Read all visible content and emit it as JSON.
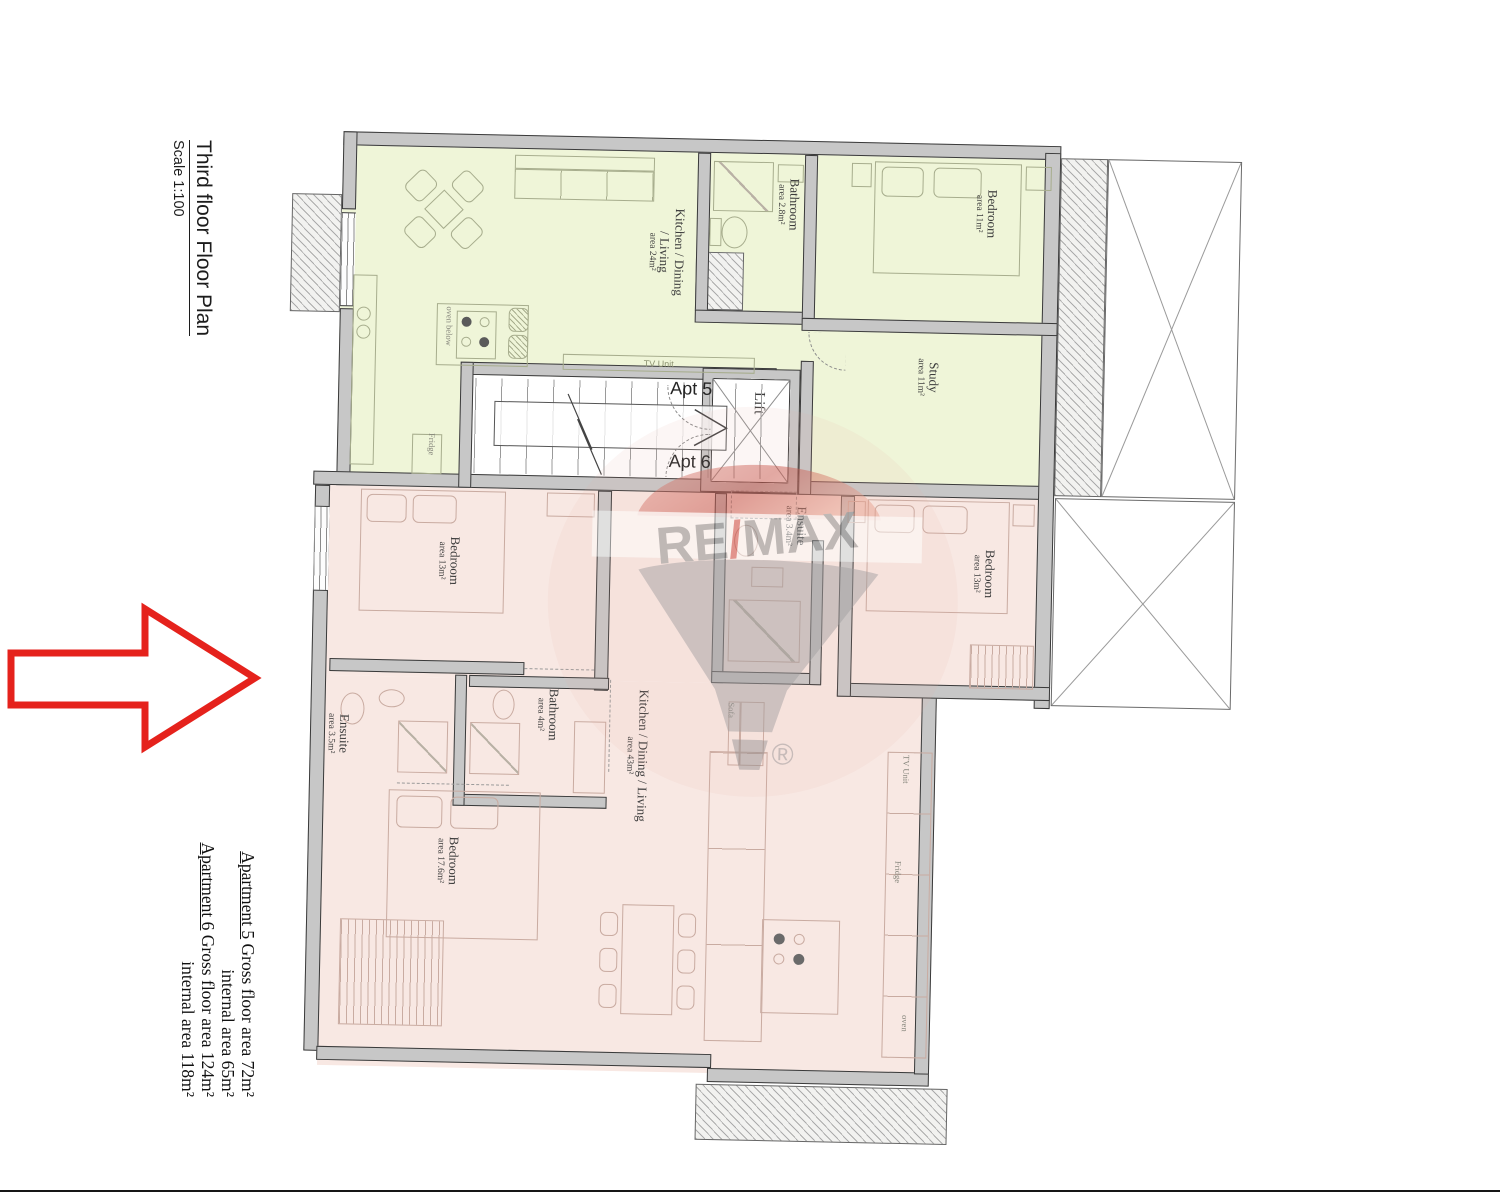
{
  "title_block": {
    "title": "Third floor Floor Plan",
    "scale": "Scale 1:100"
  },
  "area_summary": {
    "apt5_heading": "Apartment 5",
    "apt5_gross": " Gross floor area 72m²",
    "apt5_internal": "internal area 65m²",
    "apt6_heading": "Apartment 6",
    "apt6_gross": " Gross floor area 124m²",
    "apt6_internal": "internal area 118m²"
  },
  "plan": {
    "apt5_tag": "Apt 5",
    "apt6_tag": "Apt 6",
    "lift": "Lift",
    "rooms": {
      "apt5_kitchen": {
        "name": "Kitchen / Dining / Living",
        "area": "area 24m²"
      },
      "apt5_bathroom": {
        "name": "Bathroom",
        "area": "area 2.8m²"
      },
      "apt5_bedroom": {
        "name": "Bedroom",
        "area": "area 11m²"
      },
      "apt5_study": {
        "name": "Study",
        "area": "area 11m²"
      },
      "apt6_bedroom1": {
        "name": "Bedroom",
        "area": "area 13m²"
      },
      "apt6_ensuite1": {
        "name": "Ensuite",
        "area": "area 3.4m²"
      },
      "apt6_bedroom2": {
        "name": "Bedroom",
        "area": "area 13m²"
      },
      "apt6_bathroom": {
        "name": "Bathroom",
        "area": "area 4m²"
      },
      "apt6_kitchen": {
        "name": "Kitchen / Dining / Living",
        "area": "area 43m²"
      },
      "apt6_ensuite2": {
        "name": "Ensuite",
        "area": "area 3.5m²"
      },
      "apt6_bedroom3": {
        "name": "Bedroom",
        "area": "area 17.6m²"
      }
    },
    "fixtures": {
      "tv_unit": "TV Unit",
      "fridge": "Fridge",
      "oven_below": "oven below",
      "sofa": "Sofa",
      "oven": "oven"
    }
  },
  "watermark": {
    "brand_left": "RE",
    "brand_slash": "/",
    "brand_right": "MAX",
    "registered": "®"
  },
  "colors": {
    "apt5_fill": "#eff5d8",
    "apt6_fill": "#f8e8e3",
    "wall_fill": "#c7c7c7",
    "wall_line": "#3a3a3a",
    "arrow_red": "#e5221c",
    "remax_red": "#cf5a4f",
    "remax_gray": "#8d8d8d"
  }
}
